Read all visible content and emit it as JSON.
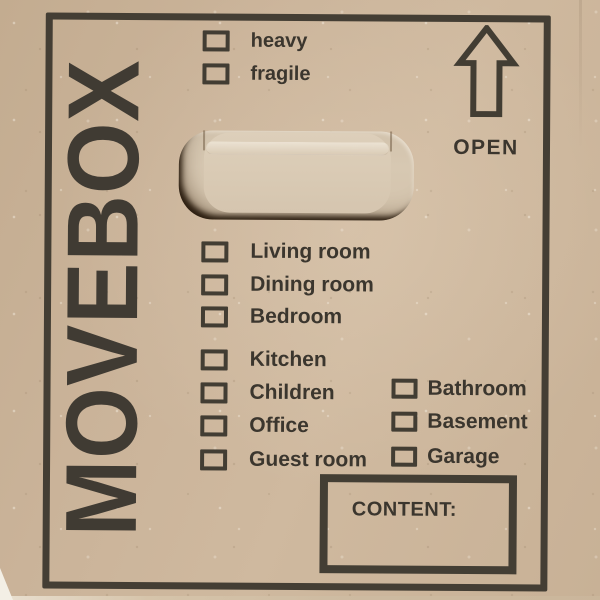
{
  "brand": {
    "name": "MOVEBOX"
  },
  "open": {
    "label": "OPEN"
  },
  "content": {
    "label": "CONTENT:"
  },
  "checklists": {
    "attributes": [
      "heavy",
      "fragile"
    ],
    "rooms_main": [
      "Living room",
      "Dining room",
      "Bedroom"
    ],
    "rooms_more": [
      "Kitchen",
      "Children",
      "Office",
      "Guest room"
    ],
    "rooms_right": [
      "Bathroom",
      "Basement",
      "Garage"
    ]
  },
  "icons": {
    "arrow": "up-arrow-outline",
    "checkbox": "empty-checkbox"
  },
  "colors": {
    "cardboard": "#c9b399",
    "ink": "#3b362e",
    "handle_flap": "#d9cab4"
  }
}
